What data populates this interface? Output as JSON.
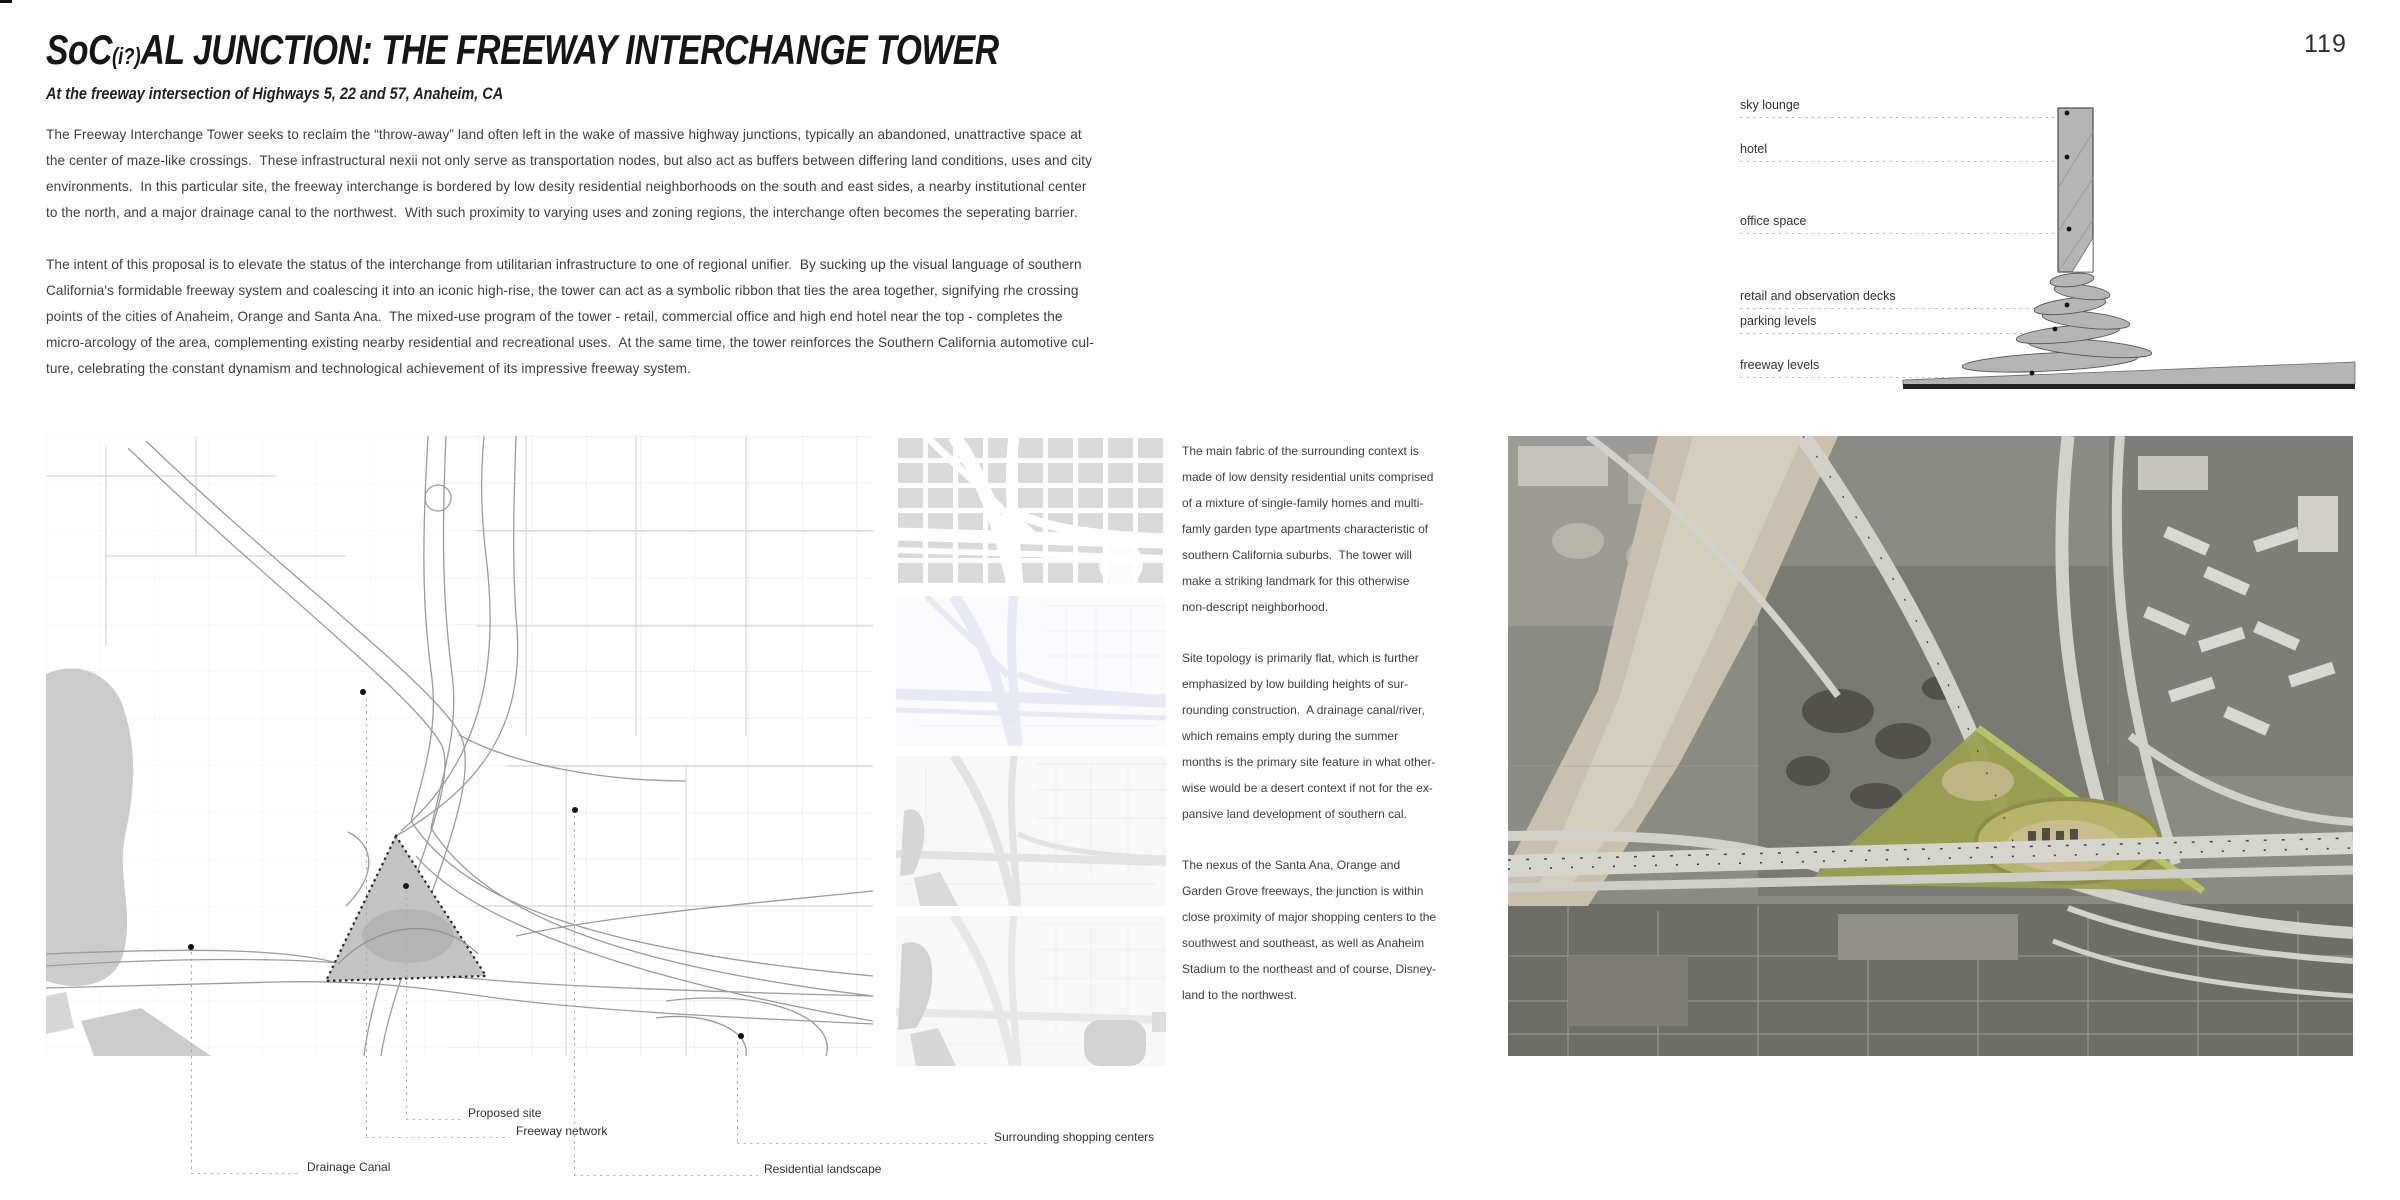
{
  "page": {
    "number": "119"
  },
  "header": {
    "title_prefix": "SoC",
    "title_small": "(i?)",
    "title_suffix": "AL JUNCTION: THE FREEWAY INTERCHANGE TOWER",
    "subtitle": "At the freeway intersection of Highways 5, 22 and 57, Anaheim, CA"
  },
  "intro": {
    "paragraph1": "The Freeway Interchange Tower seeks to reclaim the “throw-away” land often left in the wake of massive highway junctions, typically an abandoned, unattractive space at\nthe center of maze-like crossings.  These infrastructural nexii not only serve as transportation nodes, but also act as buffers between differing land conditions, uses and city\nenvironments.  In this particular site, the freeway interchange is bordered by low desity residential neighborhoods on the south and east sides, a nearby institutional center\nto the north, and a major drainage canal to the northwest.  With such proximity to varying uses and zoning regions, the interchange often becomes the seperating barrier.",
    "paragraph2": "The intent of this proposal is to elevate the status of the interchange from utilitarian infrastructure to one of regional unifier.  By sucking up the visual language of southern\nCalifornia's formidable freeway system and coalescing it into an iconic high-rise, the tower can act as a symbolic ribbon that ties the area together, signifying rhe crossing\npoints of the cities of Anaheim, Orange and Santa Ana.  The mixed-use program of the tower - retail, commercial office and high end hotel near the top - completes the\nmicro-arcology of the area, complementing existing nearby residential and recreational uses.  At the same time, the tower reinforces the Southern California automotive cul-\nture, celebrating the constant dynamism and technological achievement of its impressive freeway system."
  },
  "tower_diagram": {
    "labels": [
      "sky lounge",
      "hotel",
      "office space",
      "retail and observation decks",
      "parking levels",
      "freeway levels"
    ]
  },
  "site_map": {
    "legend": [
      "Proposed site",
      "Freeway network",
      "Drainage Canal",
      "Surrounding shopping centers",
      "Residential landscape"
    ]
  },
  "context_notes": {
    "paragraph1": "The main fabric of the surrounding context is\nmade of low density residential units comprised\nof a mixture of single-family homes and multi-\nfamly garden type apartments characteristic of\nsouthern California suburbs.  The tower will\nmake a striking landmark for this otherwise\nnon-descript neighborhood.",
    "paragraph2": "Site topology is primarily flat, which is further\nemphasized by low building heights of sur-\nrounding construction.  A drainage canal/river,\nwhich remains empty during the summer\nmonths is the primary site feature in what other-\nwise would be a desert context if not for the ex-\npansive land development of southern cal.",
    "paragraph3": "The nexus of the Santa Ana, Orange and\nGarden Grove freeways, the junction is within\nclose proximity of major shopping centers to the\nsouthwest and southeast, as well as Anaheim\nStadium to the northeast and of course, Disney-\nland to the northwest."
  },
  "colors": {
    "site_highlight": "#9aa04f",
    "diagram_fill": "#b5b5b5",
    "canal_tan": "#c8c1b0",
    "body_text": "#3d3d3d"
  }
}
